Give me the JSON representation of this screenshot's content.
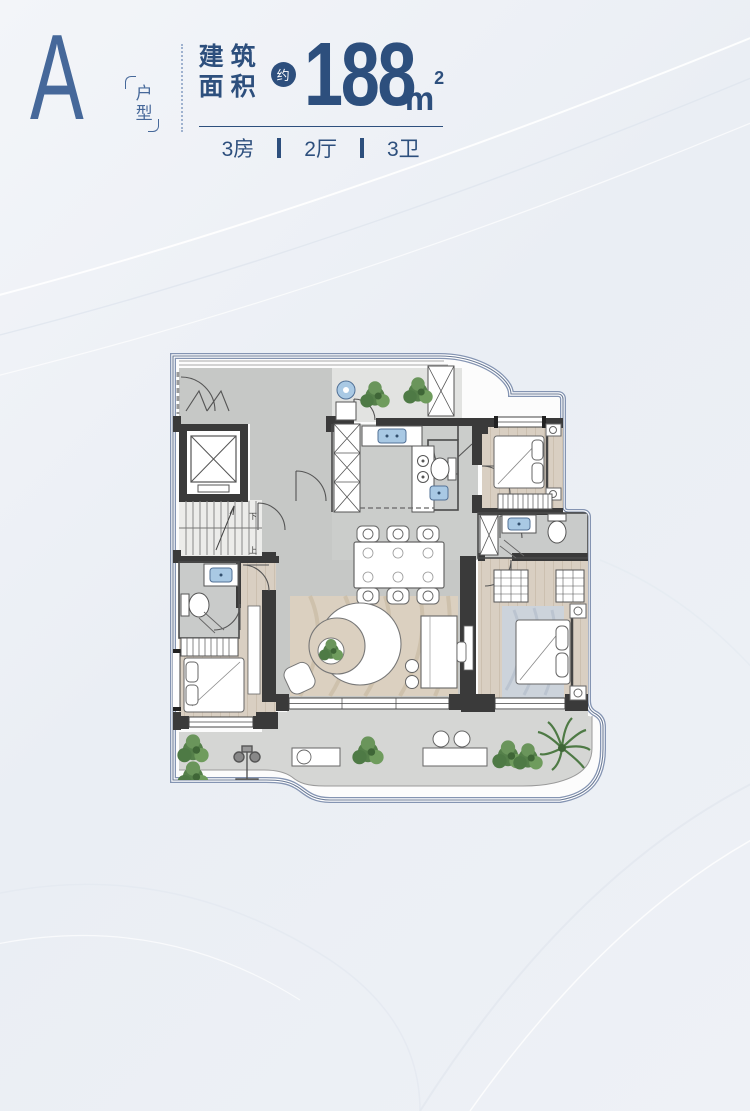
{
  "header": {
    "unit_letter": "A",
    "unit_type_vertical": "户型",
    "area_label_line1": "建筑",
    "area_label_line2": "面积",
    "approx_badge": "约",
    "area_value": "188",
    "area_unit": "m",
    "area_unit_sup": "2",
    "specs": [
      {
        "label": "3房"
      },
      {
        "label": "2厅"
      },
      {
        "label": "3卫"
      }
    ]
  },
  "floorplan": {
    "stairs_down_label": "下",
    "stairs_up_label": "上"
  },
  "colors": {
    "primary_blue": "#2d4f7d",
    "letter_blue": "#46689a",
    "plan_border": "#8494b2",
    "wall_dark": "#3a3a3a",
    "fixture_blue": "#a9c9e4",
    "wood_floor": "#d9cfc2",
    "stone_floor": "#c6c8c6",
    "balcony_floor": "#d5d6d4",
    "plant_green": "#55804a",
    "background": "#eef1f6"
  }
}
